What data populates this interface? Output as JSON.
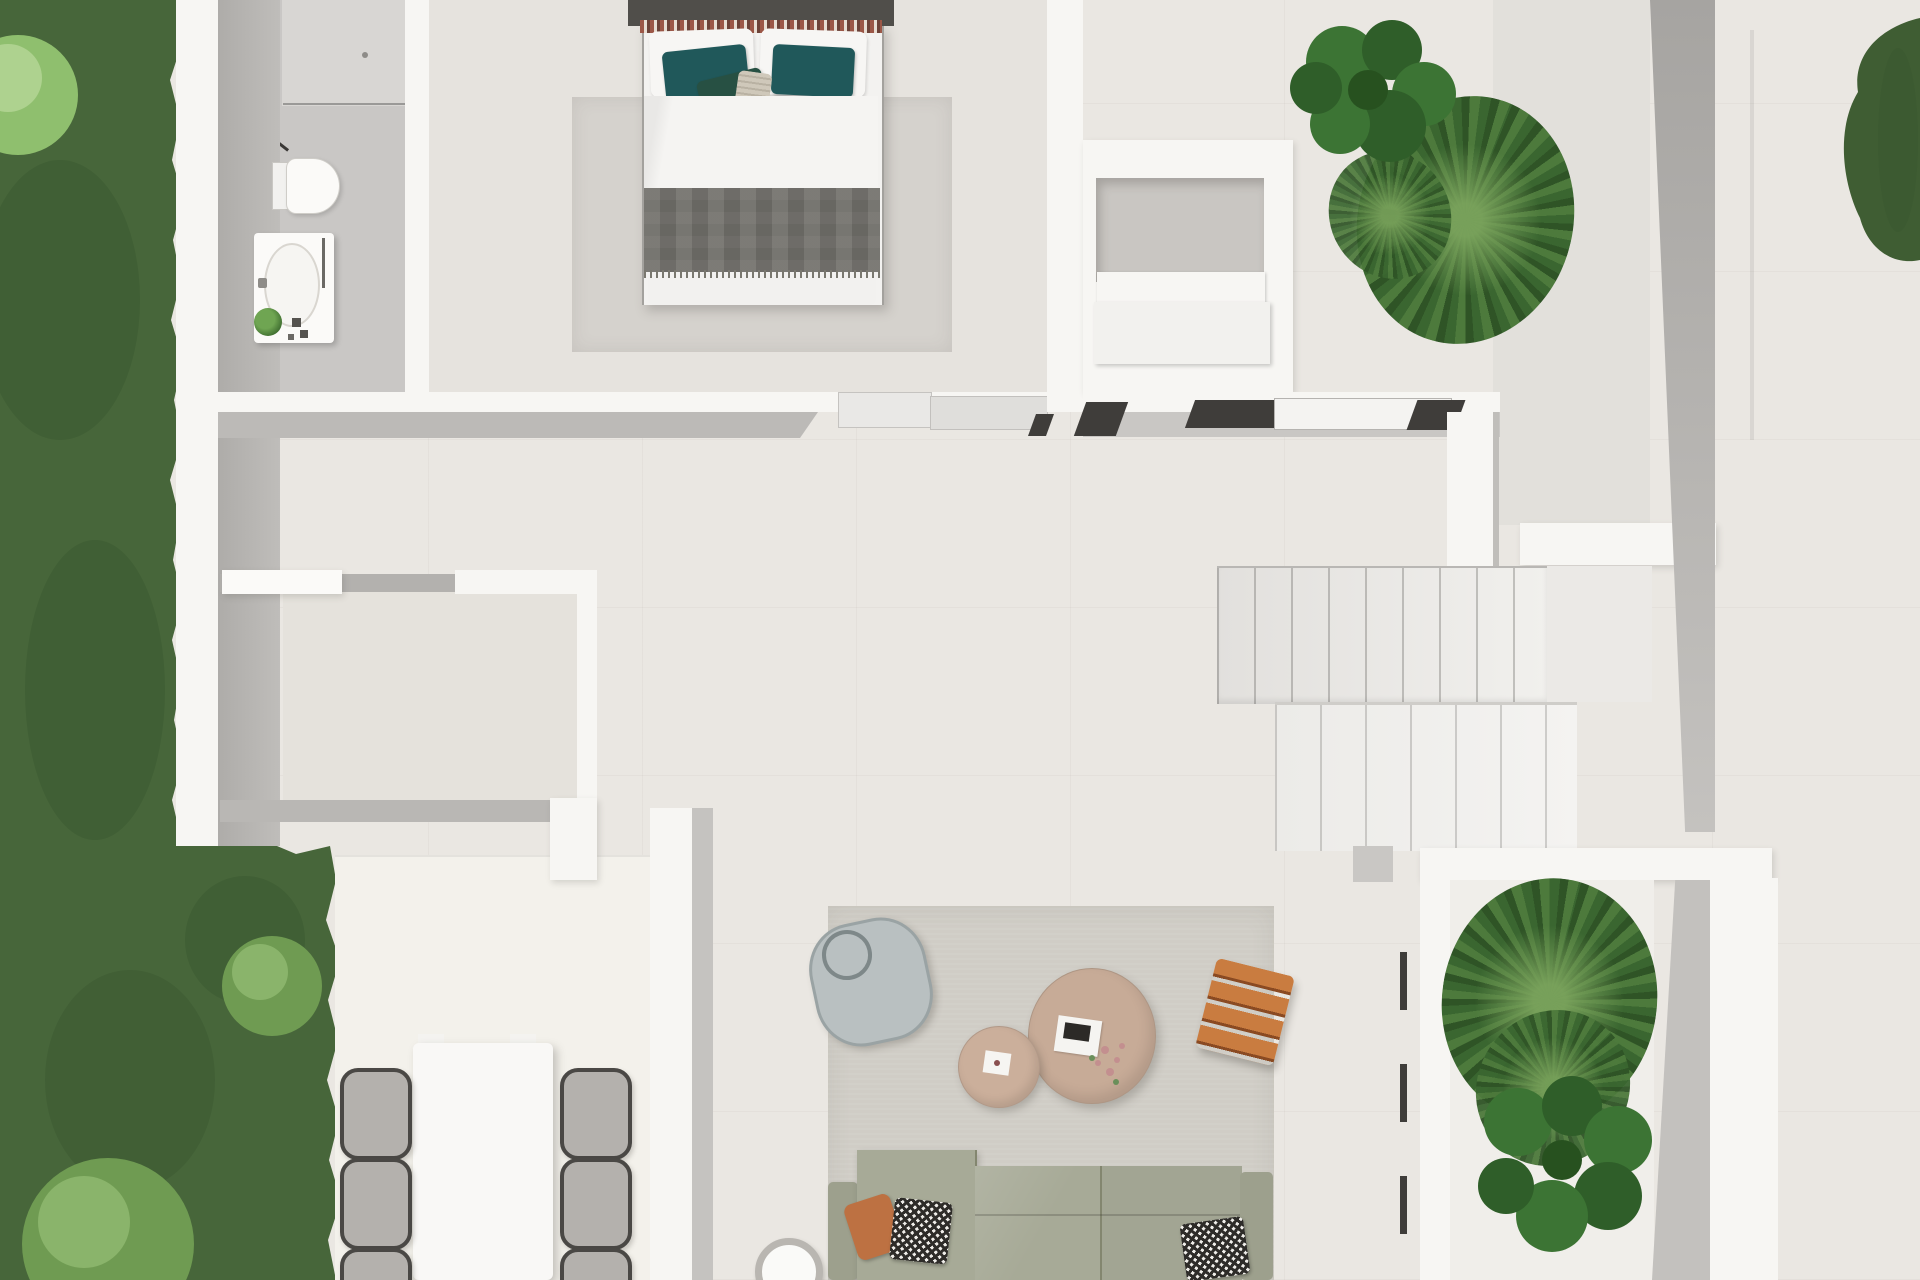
{
  "scene": {
    "view": "top-down 3D architectural floor plan render of a modern single-storey home with garden and terrace",
    "rooms": [
      {
        "name": "bathroom",
        "fixtures": [
          "walk-in shower with glass screen",
          "toilet",
          "vanity with oval basin",
          "small potted plant",
          "towel rail"
        ]
      },
      {
        "name": "bedroom",
        "furniture": [
          "double bed",
          "area rug"
        ],
        "bedding": [
          "dark headboard",
          "patterned trim runner",
          "white pillows",
          "two teal pillows",
          "dark green throw pillow",
          "knit cushion",
          "white duvet",
          "dark gray foot blanket with fringe"
        ]
      },
      {
        "name": "wardrobe-niche",
        "contents": [
          "white storage boxes stacked in wall niche"
        ]
      },
      {
        "name": "hallway",
        "features": [
          "sliding glass door tracks",
          "white sliding door panels"
        ]
      },
      {
        "name": "entry-room",
        "features": [
          "glass sliding door to terrace"
        ]
      },
      {
        "name": "staircase",
        "flights": [
          {
            "treads": 9
          },
          {
            "treads": 7
          }
        ],
        "features": [
          "landing",
          "gray side wall"
        ]
      },
      {
        "name": "storeroom",
        "features": [
          "white sliding door",
          "gray side walls"
        ]
      },
      {
        "name": "living-room",
        "furniture": [
          "gray area rug",
          "sage three-seat modular sofa",
          "terracotta pillow",
          "two checkered pillows",
          "large round tan coffee table",
          "small round tan side table",
          "round blue-gray pouf with handle",
          "orange slatted stool",
          "white round side table",
          "magazine",
          "flower sprig"
        ]
      },
      {
        "name": "outdoor-dining-deck",
        "furniture": [
          "white rectangular dining table",
          "six wire-frame chairs with gray cushions"
        ]
      },
      {
        "name": "terrace-planter",
        "plants": [
          "fan palm cluster",
          "fiddle-leaf plant"
        ]
      },
      {
        "name": "garden",
        "plants": [
          "lawn strip",
          "light round shrub top",
          "two round shrubs bottom",
          "hedge at top-right terrace edge"
        ]
      },
      {
        "name": "closet-court",
        "plants": [
          "fiddle-leaf plant",
          "fan palm"
        ]
      }
    ],
    "counts": {
      "dining_chairs": 6,
      "sofa_sections": 3,
      "coffee_tables": 2,
      "stair_flights": 2
    }
  },
  "palette": {
    "floor": "#eae7e2",
    "floorDeck": "#f3f1eb",
    "wallWhite": "#f7f6f3",
    "wallGray": "#b7b5b2",
    "wallShade": "#c6c4c1",
    "bathFloor": "#c9c7c5",
    "showerTray": "#d8d6d3",
    "glassDark": "#3a3836",
    "bedroomFloor": "#e6e3de",
    "entryFloor": "#e2e0db",
    "nicheFloor": "#c9c6c2",
    "rugBedroom": "#d5d2cd",
    "rugLiving": "#d0cdc6",
    "grass": "#47663a",
    "grassDark": "#3a5730",
    "bushLight": "#8fbf6e",
    "bushLighter": "#aed28f",
    "bushMid": "#6f9b52",
    "bushHi": "#8ab46b",
    "hedge": "#3f5d33",
    "plantDark": "#2f5e29",
    "plantMid": "#3c7434",
    "palmDark": "#2f5426",
    "palmMid": "#4d7a3c",
    "palmLight": "#3a6630",
    "sofa": "#a7aa97",
    "sofaArm": "#9da08d",
    "pillowOrange": "#bd7142",
    "pillowTeal": "#20585a",
    "pillowGreen": "#275043",
    "bedBlanket": "#6f6d68",
    "bedHeadboard": "#504e4a",
    "trimRust": "#9c5747",
    "tableTan": "#c7ab97",
    "tableTanSmall": "#cbaf9b",
    "stoolOrange": "#b06231",
    "stoolOrangeLight": "#c97c40",
    "pouf": "#b9c0c1",
    "chairCushion": "#b4b1ad",
    "chairFrame": "#4a4845",
    "whiteFurniture": "#f9f8f6",
    "stairTread": "#edebe8",
    "trackDark": "#3f3d3a"
  }
}
